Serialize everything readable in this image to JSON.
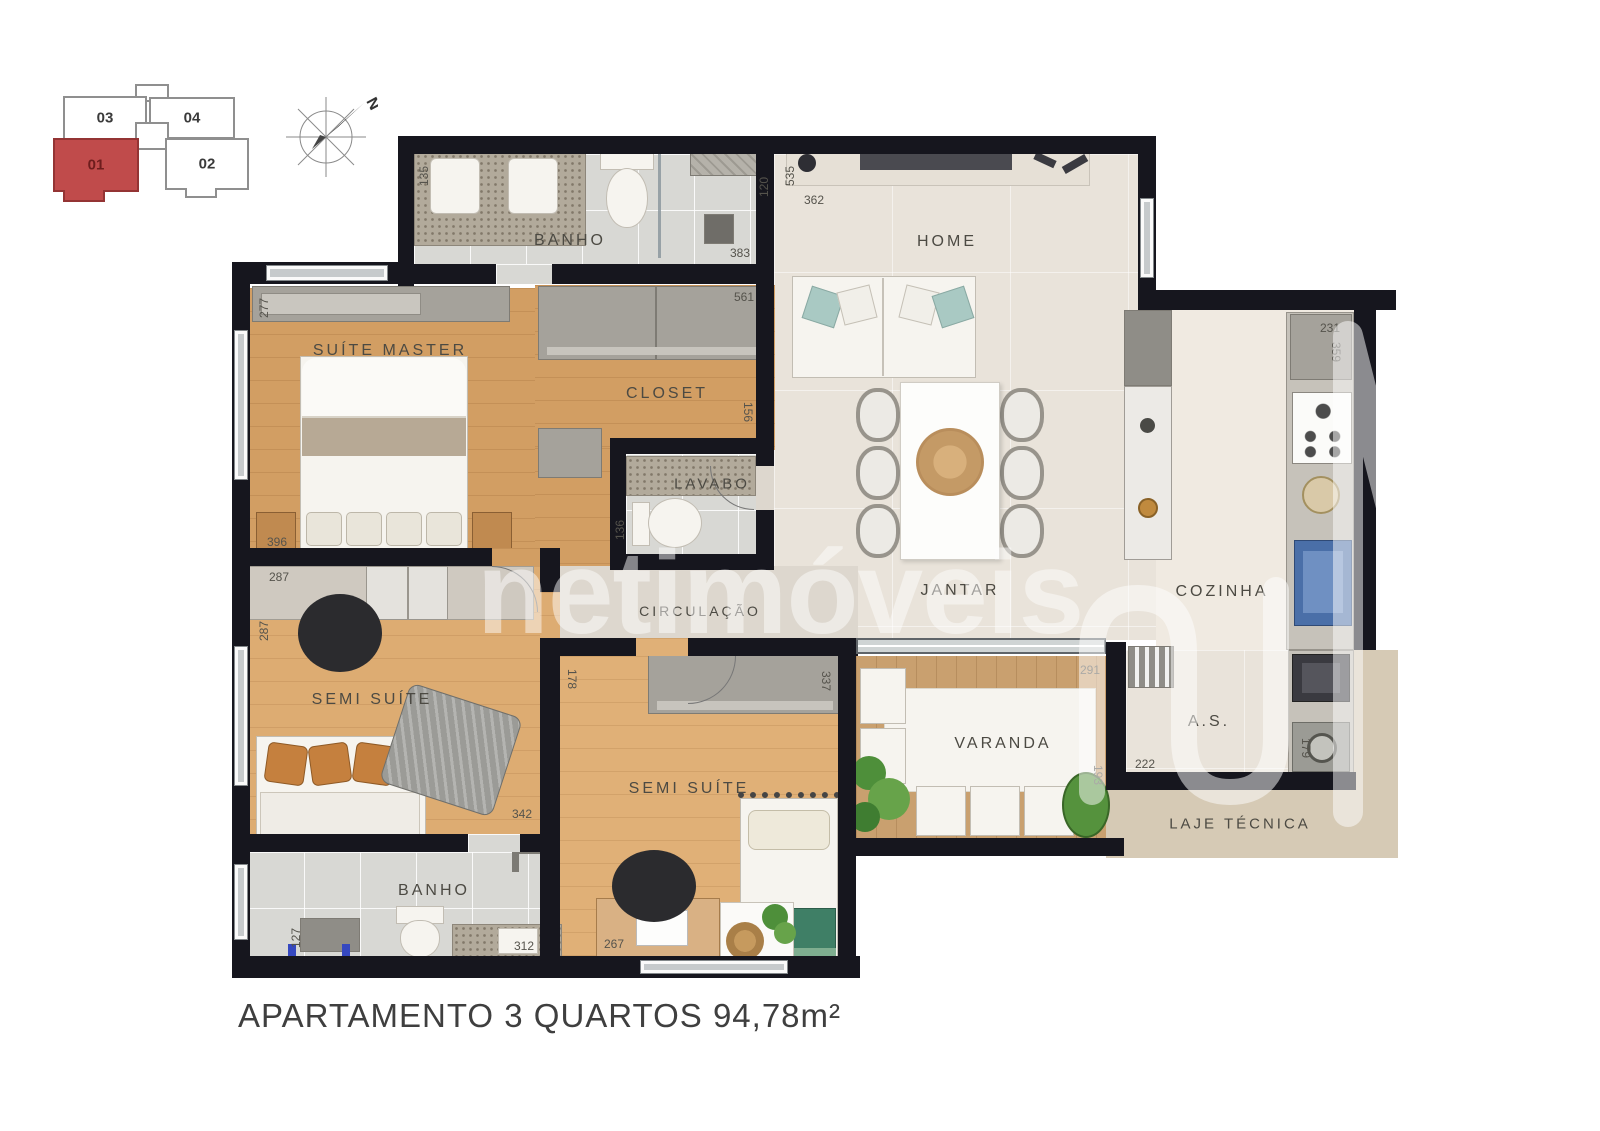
{
  "caption": "APARTAMENTO 3 QUARTOS 94,78m²",
  "watermark": {
    "text": "netimóveis"
  },
  "compass": {
    "north_label": "N"
  },
  "key_plan": {
    "units": [
      {
        "label": "03",
        "highlighted": false
      },
      {
        "label": "04",
        "highlighted": false
      },
      {
        "label": "01",
        "highlighted": true
      },
      {
        "label": "02",
        "highlighted": false
      }
    ]
  },
  "rooms": {
    "banho_top": "BANHO",
    "home": "HOME",
    "suite_master": "SUÍTE MASTER",
    "closet": "CLOSET",
    "lavabo": "LAVABO",
    "circulacao": "CIRCULAÇÃO",
    "jantar": "JANTAR",
    "cozinha": "COZINHA",
    "semi_suite_1": "SEMI SUÍTE",
    "semi_suite_2": "SEMI SUÍTE",
    "varanda": "VARANDA",
    "area_servico": "A.S.",
    "laje_tecnica": "LAJE TÉCNICA",
    "banho_bottom": "BANHO"
  },
  "dimensions": [
    {
      "value": "135"
    },
    {
      "value": "120"
    },
    {
      "value": "383"
    },
    {
      "value": "561"
    },
    {
      "value": "535"
    },
    {
      "value": "362"
    },
    {
      "value": "277"
    },
    {
      "value": "396"
    },
    {
      "value": "287"
    },
    {
      "value": "287"
    },
    {
      "value": "156"
    },
    {
      "value": "136"
    },
    {
      "value": "178"
    },
    {
      "value": "342"
    },
    {
      "value": "337"
    },
    {
      "value": "267"
    },
    {
      "value": "127"
    },
    {
      "value": "312"
    },
    {
      "value": "291"
    },
    {
      "value": "193"
    },
    {
      "value": "222"
    },
    {
      "value": "231"
    },
    {
      "value": "359"
    },
    {
      "value": "179"
    }
  ],
  "colors": {
    "wall": "#16161e",
    "tile": "#d8d8d4",
    "wood1": "#d29e63",
    "wood2": "#ddac72",
    "wood3": "#e0b077",
    "beige": "#e9e3da",
    "kitchen": "#f0eae1",
    "circ": "#ddd7ce",
    "deck": "#c9a06f",
    "laje": "#d6cab5",
    "granite": "#b2aa9b",
    "furn": "#a5a29b",
    "red": "#c04b4b",
    "teal": "#a9c9c3",
    "green": "#3f7f66",
    "orange": "#c5803e",
    "blue": "#4a6fa8",
    "label": "#4c4a43",
    "dim": "#55534c",
    "caption": "#3f3f3f"
  }
}
